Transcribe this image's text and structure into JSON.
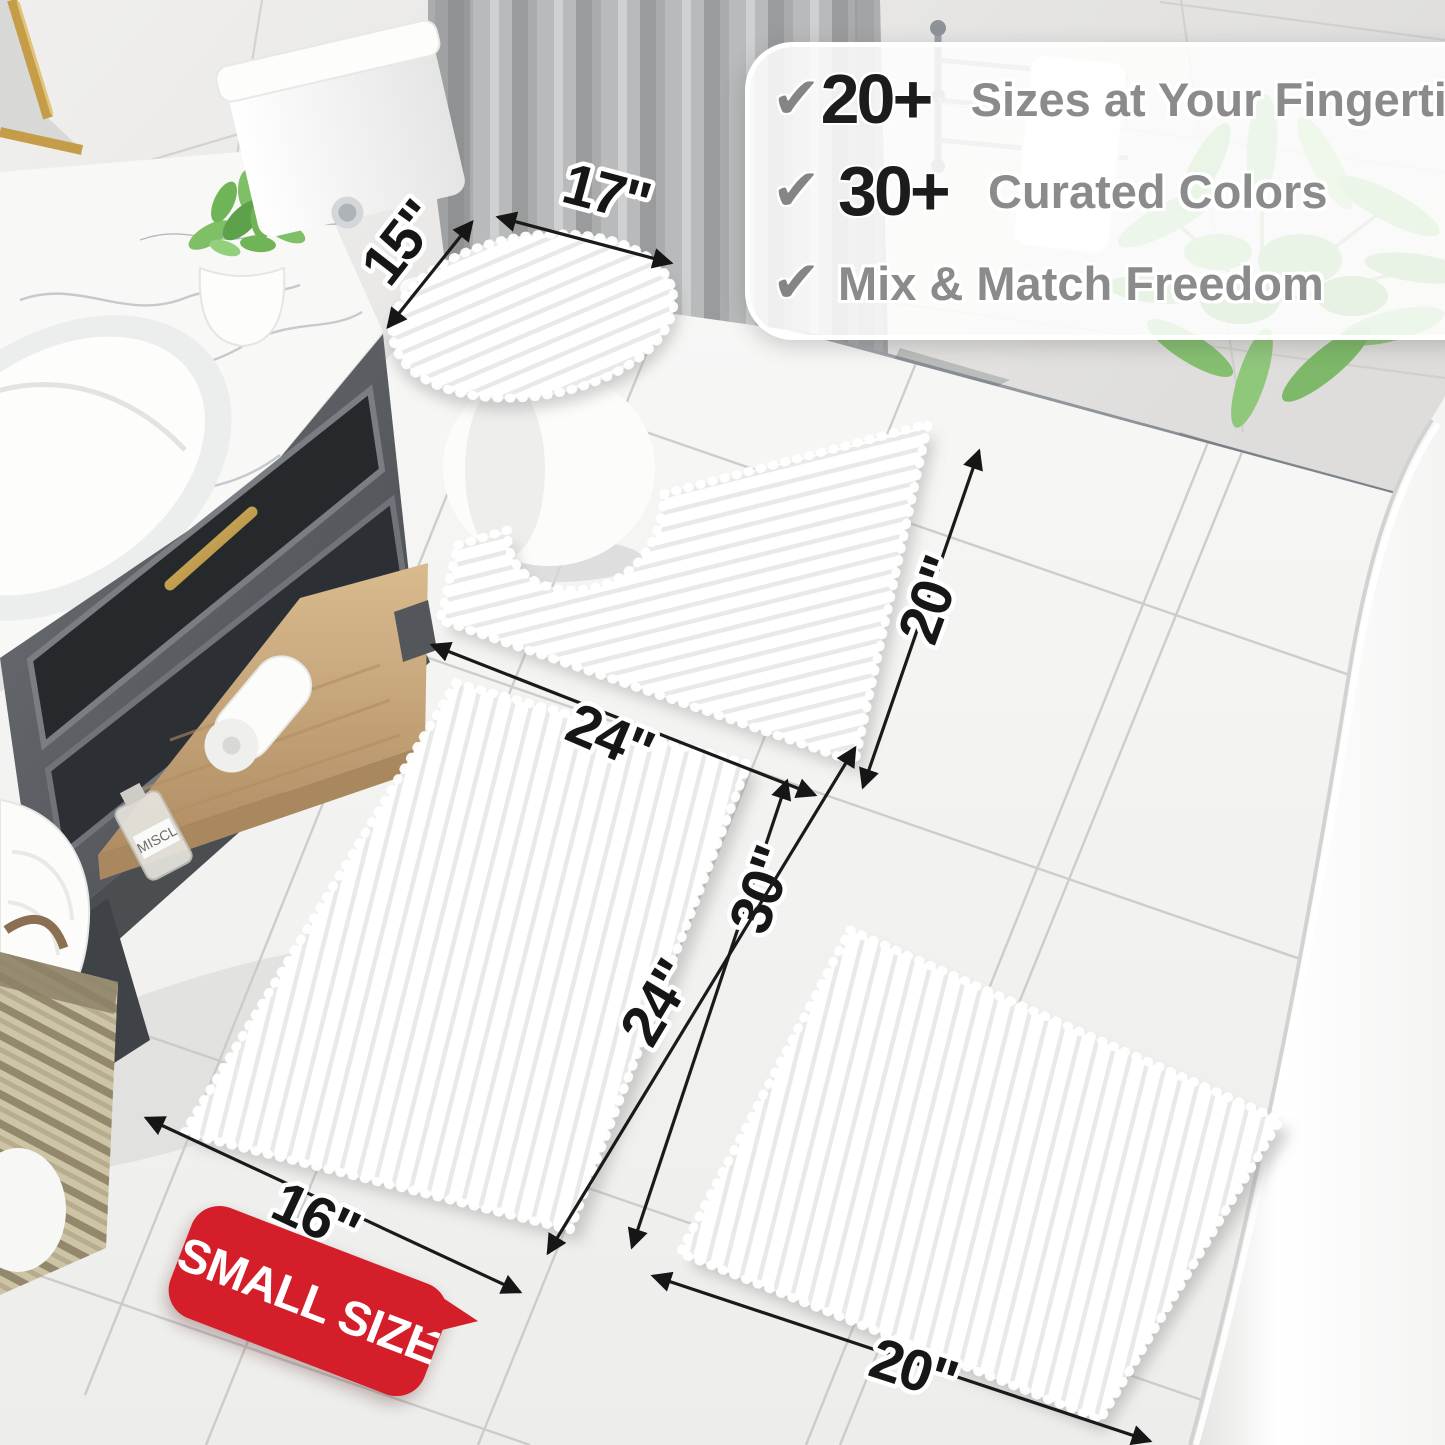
{
  "callout": {
    "check_icon": "✔",
    "rows": [
      {
        "stat": "20+",
        "label": "Sizes at Your Fingertips"
      },
      {
        "stat": "30+",
        "label": "Curated Colors"
      },
      {
        "stat": "",
        "label": "Mix & Match Freedom"
      }
    ]
  },
  "dimensions": {
    "lid_depth": "15\"",
    "lid_width": "17\"",
    "contour_width": "24\"",
    "contour_depth": "20\"",
    "runner_length": "30\"",
    "small_rug_length": "24\"",
    "small_rug_width": "16\"",
    "large_rug_width": "20\""
  },
  "badge": {
    "label": "SMALL SIZE"
  },
  "bottle": {
    "label": "MISCL"
  },
  "colors": {
    "badge_red": "#d41f2b",
    "arrow_black": "#161616",
    "stat_black": "#1c1c1c",
    "text_gray": "#8b8b8b",
    "gold": "#c9a254",
    "plant_green": "#7fbd63",
    "rug_white": "#ffffff",
    "cabinet_dark": "#2b2e31"
  }
}
